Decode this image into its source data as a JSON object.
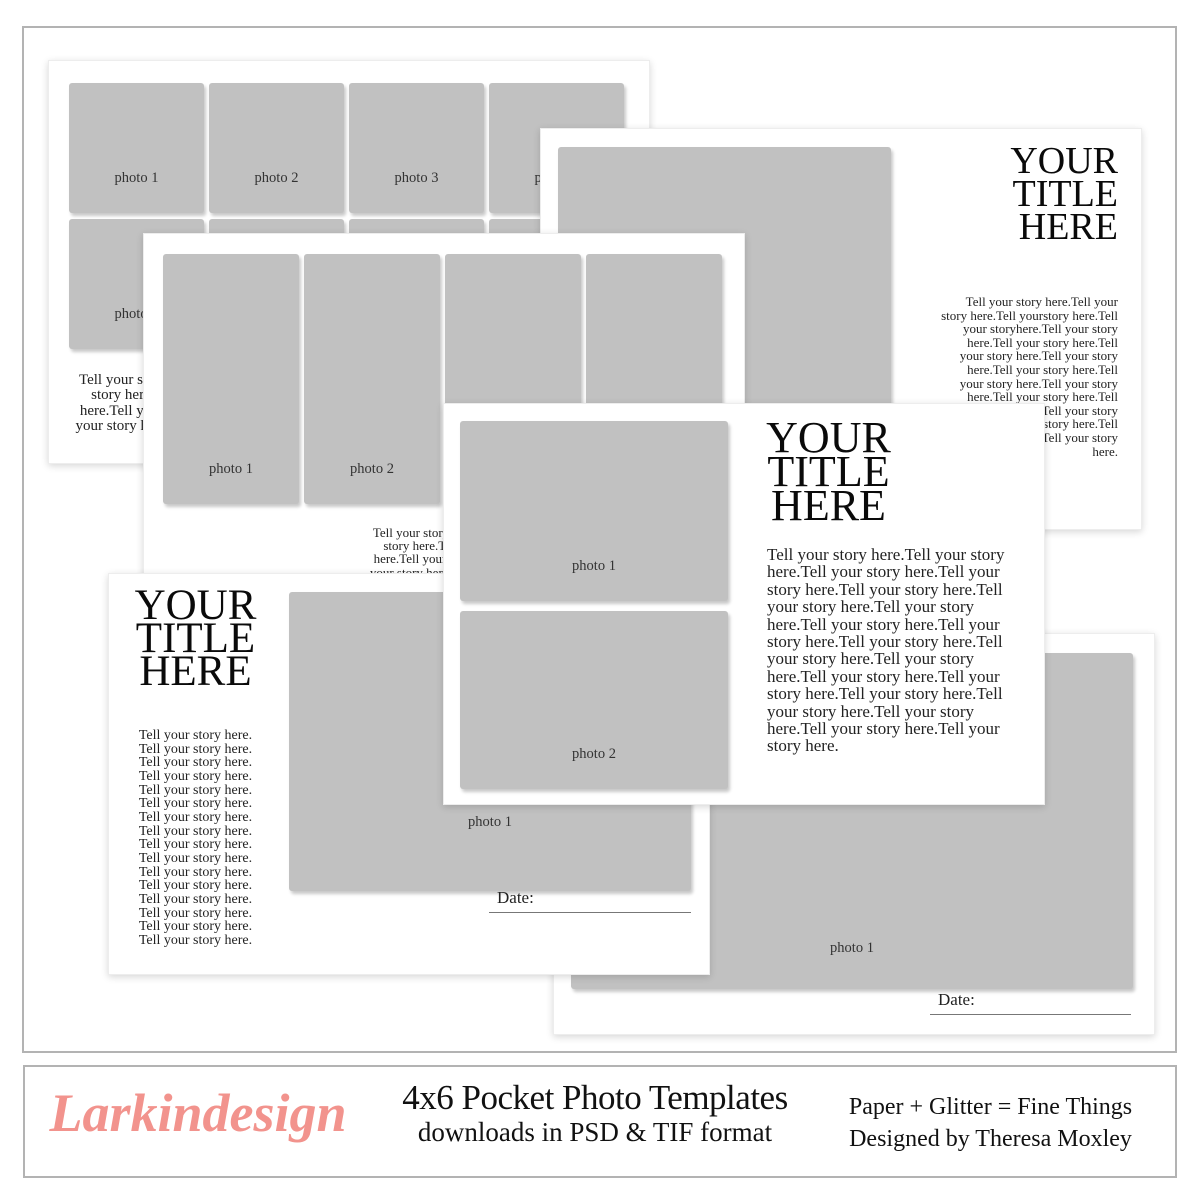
{
  "page": {
    "photo_fill": "#c1c1c1",
    "frame_border": "#b3b3b3"
  },
  "cards": {
    "grid_squares": {
      "photos": [
        "photo 1",
        "photo 2",
        "photo 3",
        "photo 4",
        "photo 5",
        "photo 6",
        "photo 7",
        "photo 8"
      ],
      "story": "Tell your story here.Tell your story here.Tell your story here.Tell your story here.Tell your story here.Tell your story here.Tell your story here.Tell your story here.Tell your story here.Tell your story here.Tell your story here.Tell your story here.Tell your story here.Tell your story here.Tell your story here.Tell your story here.Tell your story here.Tell your story here."
    },
    "pockets_vertical": {
      "photos": [
        "photo 1",
        "photo 2",
        "photo 3",
        "photo 4"
      ],
      "story": "Tell your story here.Tell your story here.Tell your story here.Tell your story here.Tell your story here.Tell your story here."
    },
    "photo_title_right": {
      "photo": "photo 1",
      "title": "YOUR\nTITLE\nHERE",
      "story": "Tell your story here.Tell your story here.Tell yourstory here.Tell your storyhere.Tell your story here.Tell your story here.Tell your story here.Tell your story here.Tell your story here.Tell your story here.Tell your story here.Tell your story here.Tell your story here.Tell your story here.Tell your story here.Tell your story here.Tell your story here."
    },
    "two_photos_title": {
      "photos": [
        "photo 1",
        "photo 2"
      ],
      "title": "YOUR\nTITLE\nHERE",
      "story": "Tell your story here.Tell your story here.Tell your story here.Tell your story here.Tell your story here.Tell your story here.Tell your story here.Tell your story here.Tell your story here.Tell your story here.Tell your story here.Tell your story here.Tell your story here.Tell your story here.Tell your story here.Tell your story here.Tell your story here.Tell your story here.Tell your story here."
    },
    "title_left_photo": {
      "title": "YOUR\nTITLE\nHERE",
      "story_lines": [
        "Tell your story here.",
        "Tell your story here.",
        "Tell your story here.",
        "Tell your story here.",
        "Tell your story here.",
        "Tell your story here.",
        "Tell your story here.",
        "Tell your story here.",
        "Tell your story here.",
        "Tell your story here.",
        "Tell your story here.",
        "Tell your story here.",
        "Tell your story here.",
        "Tell your story here.",
        "Tell your story here.",
        "Tell your story here."
      ],
      "photo": "photo 1",
      "date_label": "Date:"
    },
    "big_photo_date": {
      "photo": "photo 1",
      "date_label": "Date:"
    }
  },
  "footer": {
    "logo": "Larkindesign",
    "logo_color": "#f2938d",
    "title": "4x6 Pocket Photo Templates",
    "subtitle": "downloads in PSD & TIF format",
    "credit_line1": "Paper + Glitter = Fine Things",
    "credit_line2": "Designed by Theresa Moxley"
  }
}
